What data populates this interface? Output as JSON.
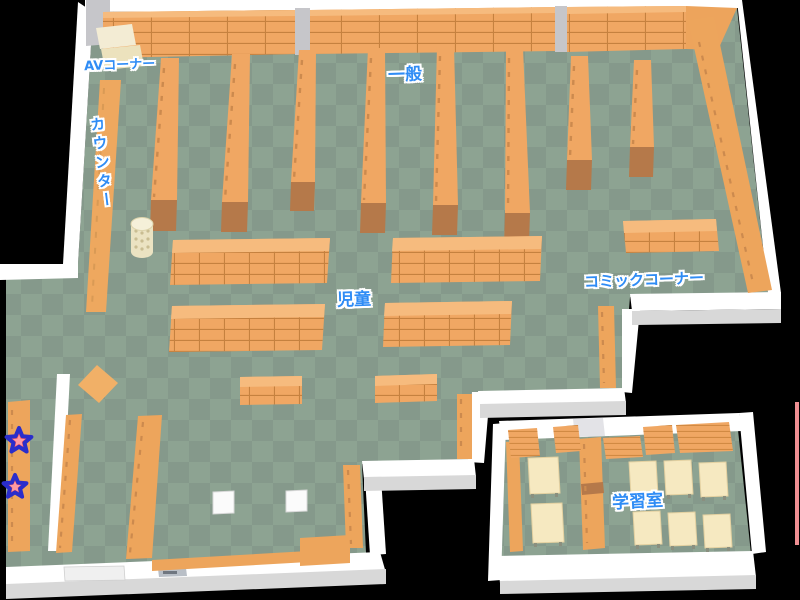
{
  "map": {
    "type": "library-floor-map",
    "labels": {
      "av_corner": "AVコーナー",
      "general": "一般",
      "counter": "カウンター",
      "children": "児童",
      "comic_corner": "コミックコーナー",
      "study_room": "学習室"
    },
    "markers": {
      "icon": "star-icon",
      "count": 2
    },
    "colors": {
      "background": "#000000",
      "floor_light": "#8da392",
      "floor_dark": "#85998b",
      "wall": "#ffffff",
      "wall_shadow": "#d8d8d8",
      "pillar": "#c6c6ca",
      "shelf": "#f0a763",
      "shelf_line": "#c5813f",
      "shelf_highlight": "#f6bb7e",
      "shelf_foot": "#b5794a",
      "cream_cabinet": "#f3ecd4",
      "table_cream": "#f6e9c1",
      "label_blue": "#2f8cf5",
      "label_outline": "#ffffff",
      "star_fill": "#f2535f",
      "star_outline": "#2a2dcb",
      "edge_line_pink": "#ef8f93"
    }
  }
}
